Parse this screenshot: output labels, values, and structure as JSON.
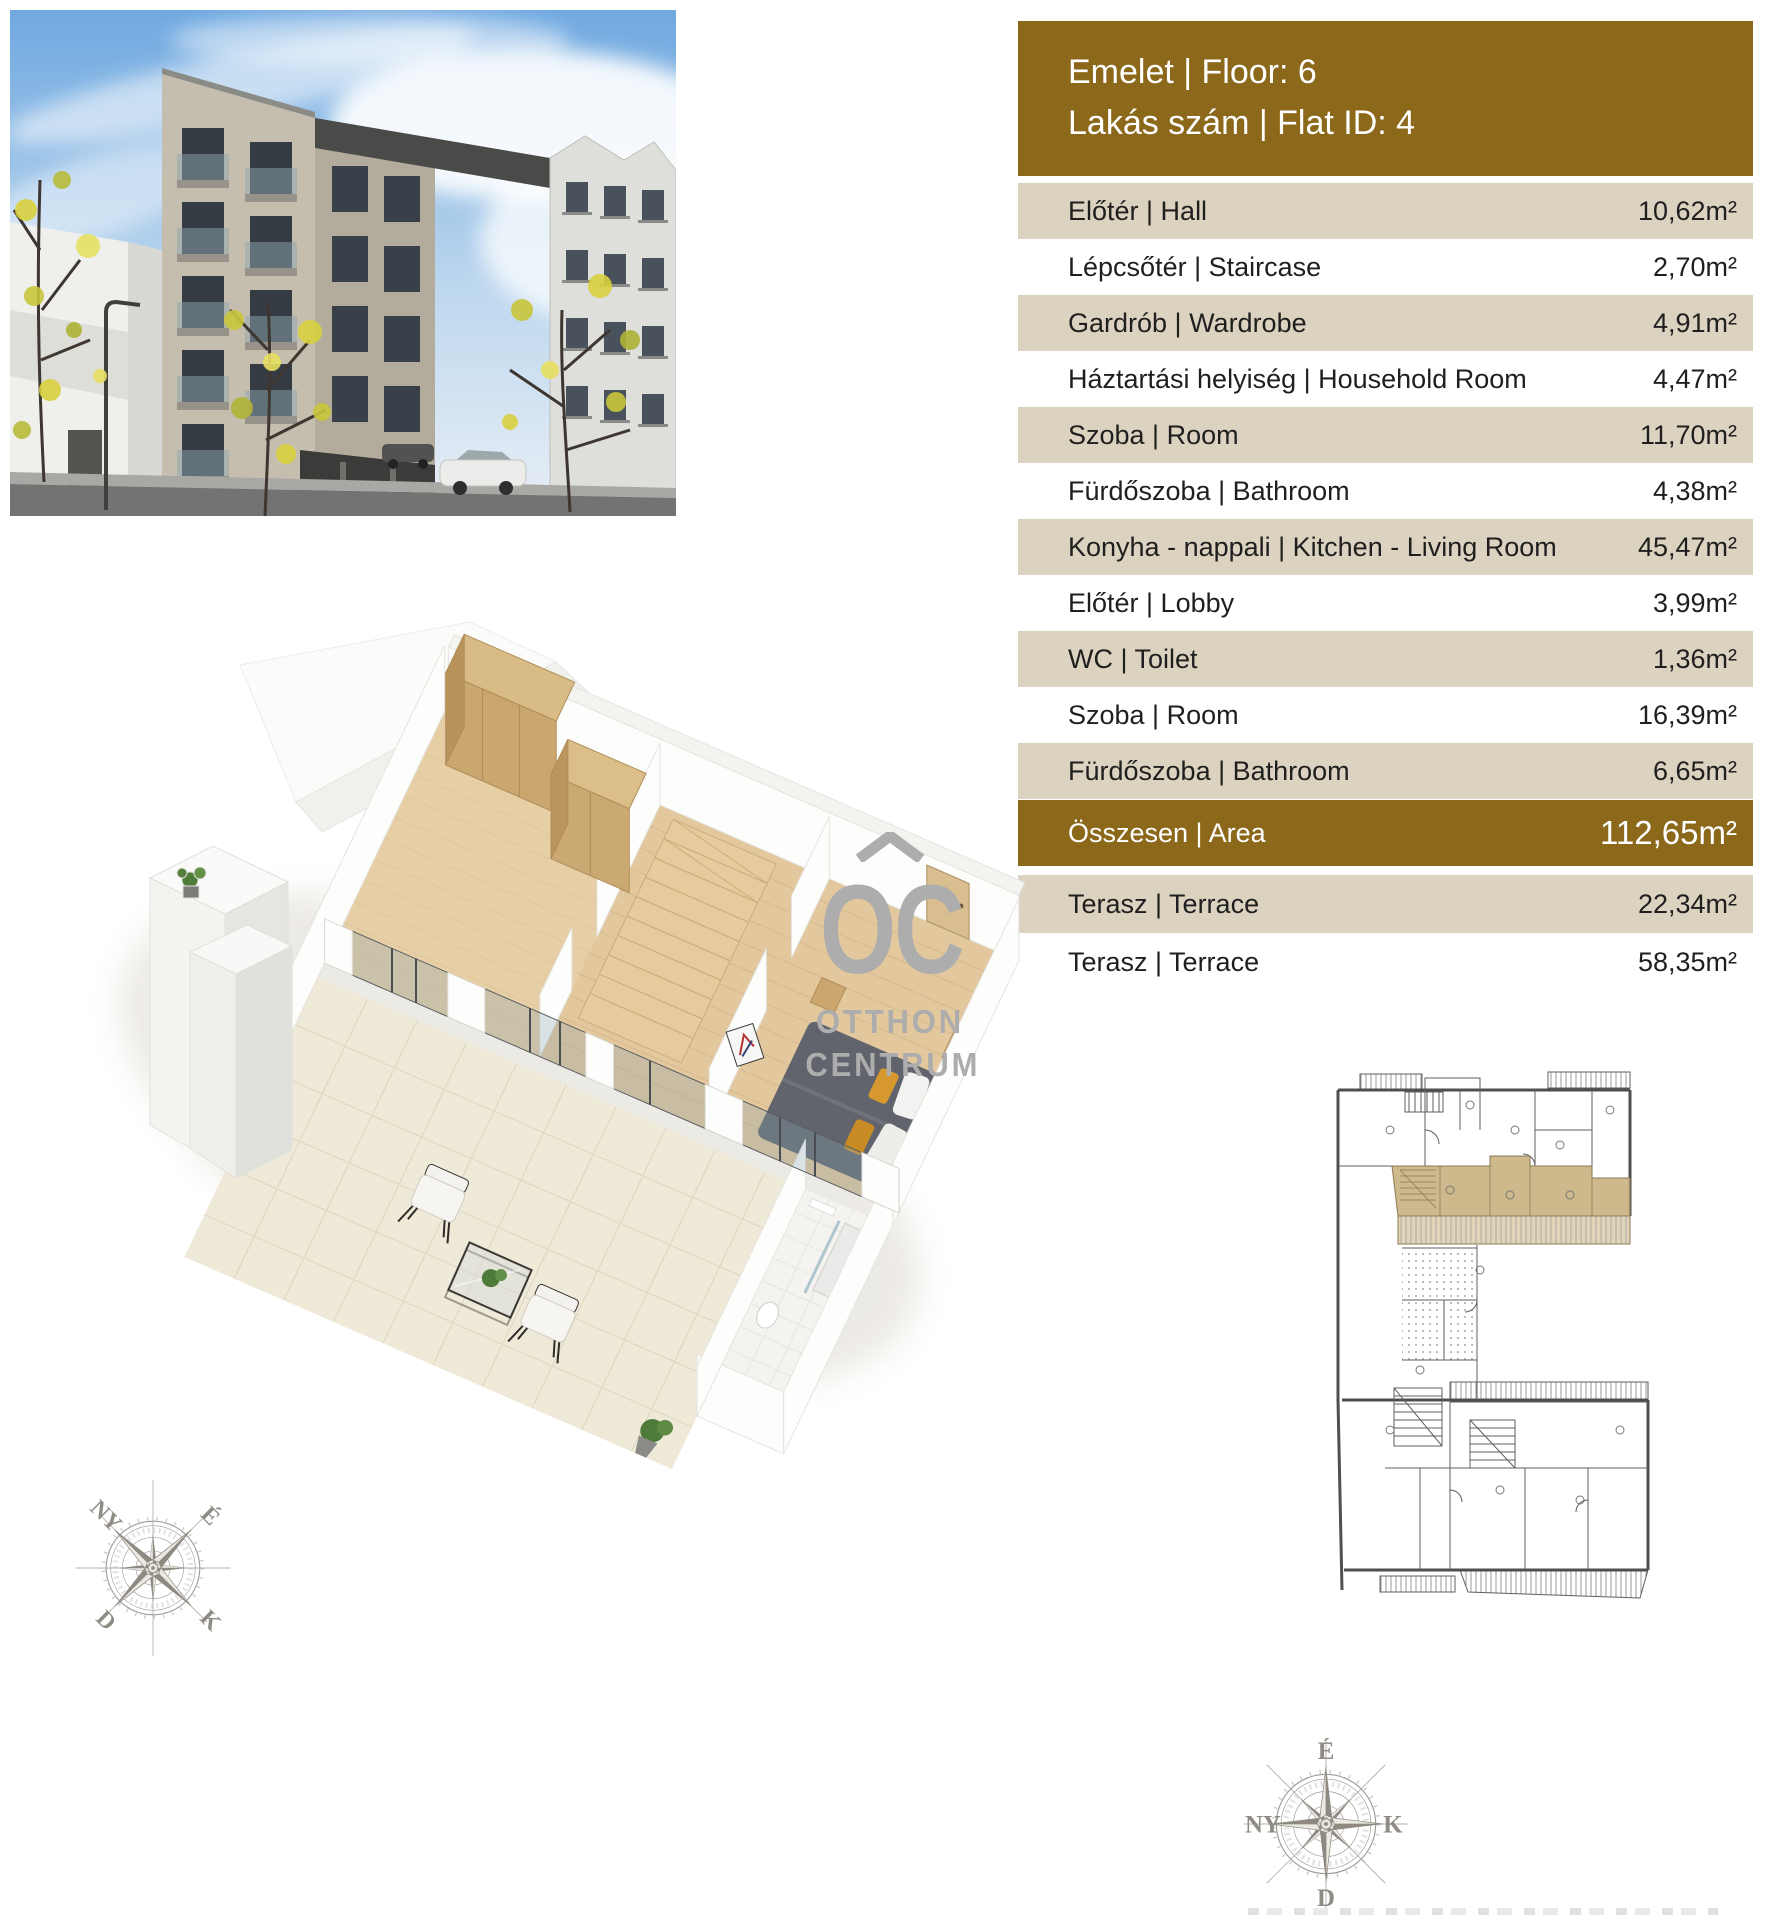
{
  "colors": {
    "accent_gold": "#8C681A",
    "row_beige": "#DBD3BF",
    "text_dark": "#1F1F1F",
    "logo_gray": "#ADADAD",
    "plan_highlight": "#C9B180"
  },
  "header": {
    "floor_line": "Emelet | Floor: 6",
    "flat_line": "Lakás szám | Flat ID: 4"
  },
  "area_table": {
    "rows": [
      {
        "label": "Előtér | Hall",
        "area": "10,62m²"
      },
      {
        "label": "Lépcsőtér | Staircase",
        "area": "2,70m²"
      },
      {
        "label": "Gardrób | Wardrobe",
        "area": "4,91m²"
      },
      {
        "label": "Háztartási helyiség | Household Room",
        "area": "4,47m²"
      },
      {
        "label": "Szoba | Room",
        "area": "11,70m²"
      },
      {
        "label": "Fürdőszoba | Bathroom",
        "area": "4,38m²"
      },
      {
        "label": "Konyha - nappali | Kitchen - Living Room",
        "area": "45,47m²"
      },
      {
        "label": "Előtér | Lobby",
        "area": "3,99m²"
      },
      {
        "label": "WC | Toilet",
        "area": "1,36m²"
      },
      {
        "label": "Szoba | Room",
        "area": "16,39m²"
      },
      {
        "label": "Fürdőszoba | Bathroom",
        "area": "6,65m²"
      }
    ],
    "summary": {
      "label": "Összesen | Area",
      "area": "112,65m²"
    },
    "terrace_rows": [
      {
        "label": "Terasz | Terrace",
        "area": "22,34m²"
      },
      {
        "label": "Terasz | Terrace",
        "area": "58,35m²"
      }
    ]
  },
  "logo": {
    "monogram": "OC",
    "word1": "OTTHON",
    "word2": "CENTRUM"
  },
  "compass_left": {
    "top_left": "NY",
    "top_right": "É",
    "bottom_left": "D",
    "bottom_right": "K"
  },
  "compass_right": {
    "north": "É",
    "east": "K",
    "south": "D",
    "west": "NY"
  }
}
